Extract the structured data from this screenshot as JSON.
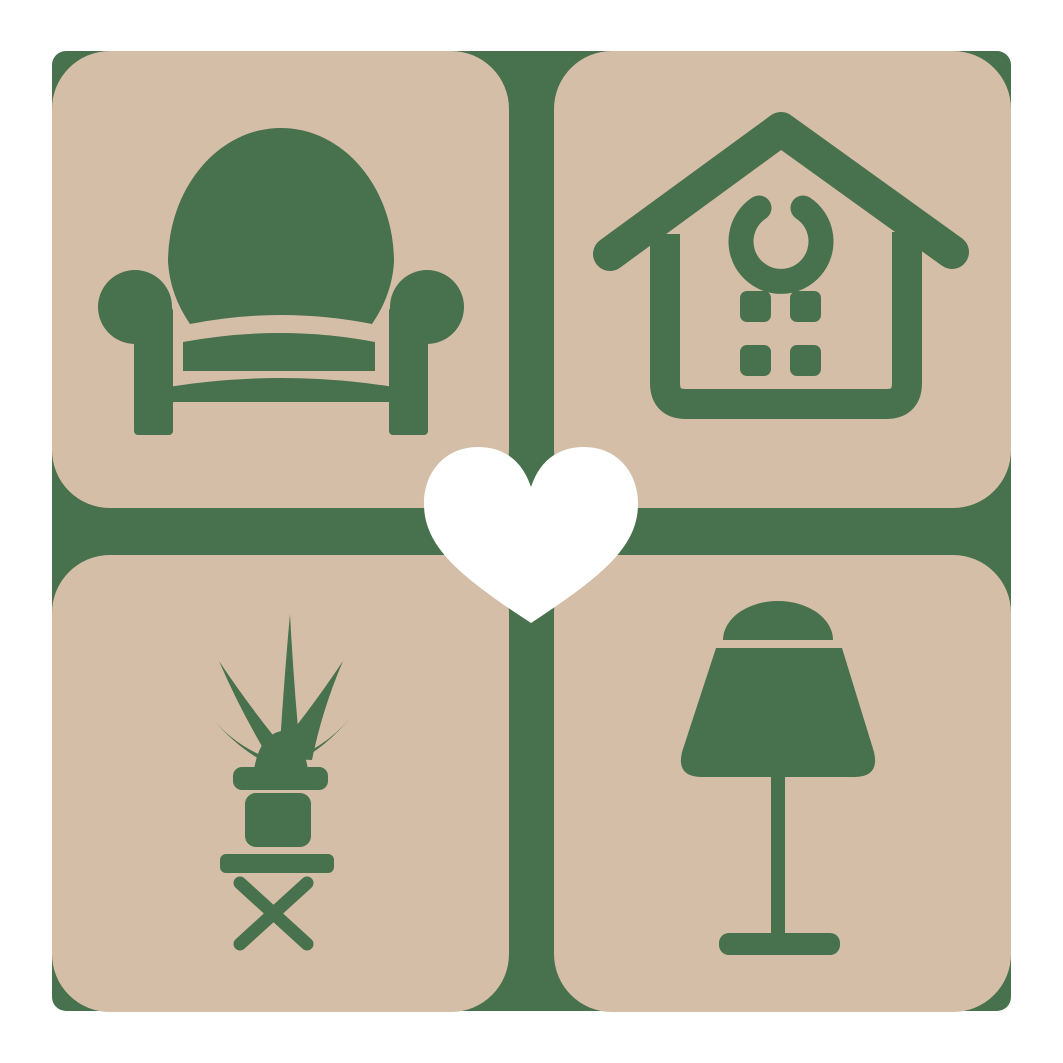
{
  "logo": {
    "colors": {
      "canvas": "#ffffff",
      "tile": "#d5bea8",
      "accent": "#48714d",
      "heart": "#ffffff"
    },
    "grid": {
      "rows": 2,
      "cols": 2,
      "tile_count": 4
    },
    "tiles": [
      {
        "position": "top-left",
        "subject": "armchair"
      },
      {
        "position": "top-right",
        "subject": "house"
      },
      {
        "position": "bottom-left",
        "subject": "potted-plant-on-table"
      },
      {
        "position": "bottom-right",
        "subject": "table-lamp"
      }
    ],
    "center": {
      "subject": "heart"
    }
  }
}
